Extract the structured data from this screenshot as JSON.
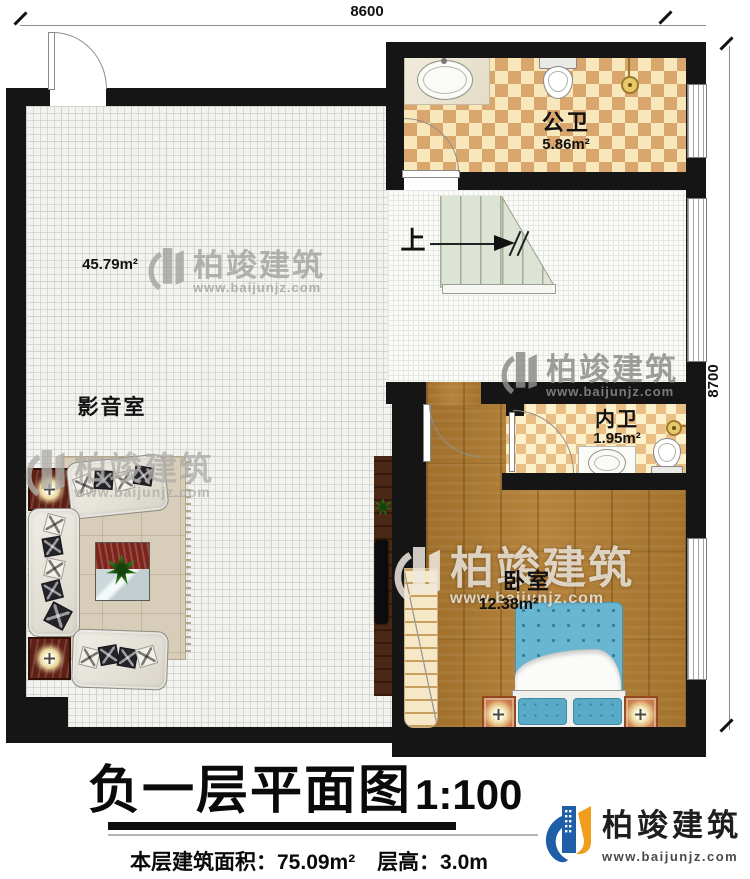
{
  "dimensions": {
    "top": "8600",
    "right": "8700"
  },
  "rooms": {
    "media": {
      "name": "影音室",
      "area": "45.79m²"
    },
    "public_bath": {
      "name": "公卫",
      "area": "5.86m²"
    },
    "inner_bath": {
      "name": "内卫",
      "area": "1.95m²"
    },
    "bedroom": {
      "name": "卧室",
      "area": "12.38m²"
    }
  },
  "stairs": {
    "up_label": "上"
  },
  "title_block": {
    "title": "负一层平面图",
    "scale": "1:100",
    "floor_area": "本层建筑面积：75.09m²",
    "floor_height": "层高：3.0m"
  },
  "branding": {
    "company": "柏竣建筑",
    "website": "www.baijunjz.com",
    "brand_blue": "#1e5fa8",
    "brand_orange": "#f09d1c"
  },
  "watermark": {
    "company": "柏竣建筑",
    "website": "www.baijunjz.com"
  }
}
